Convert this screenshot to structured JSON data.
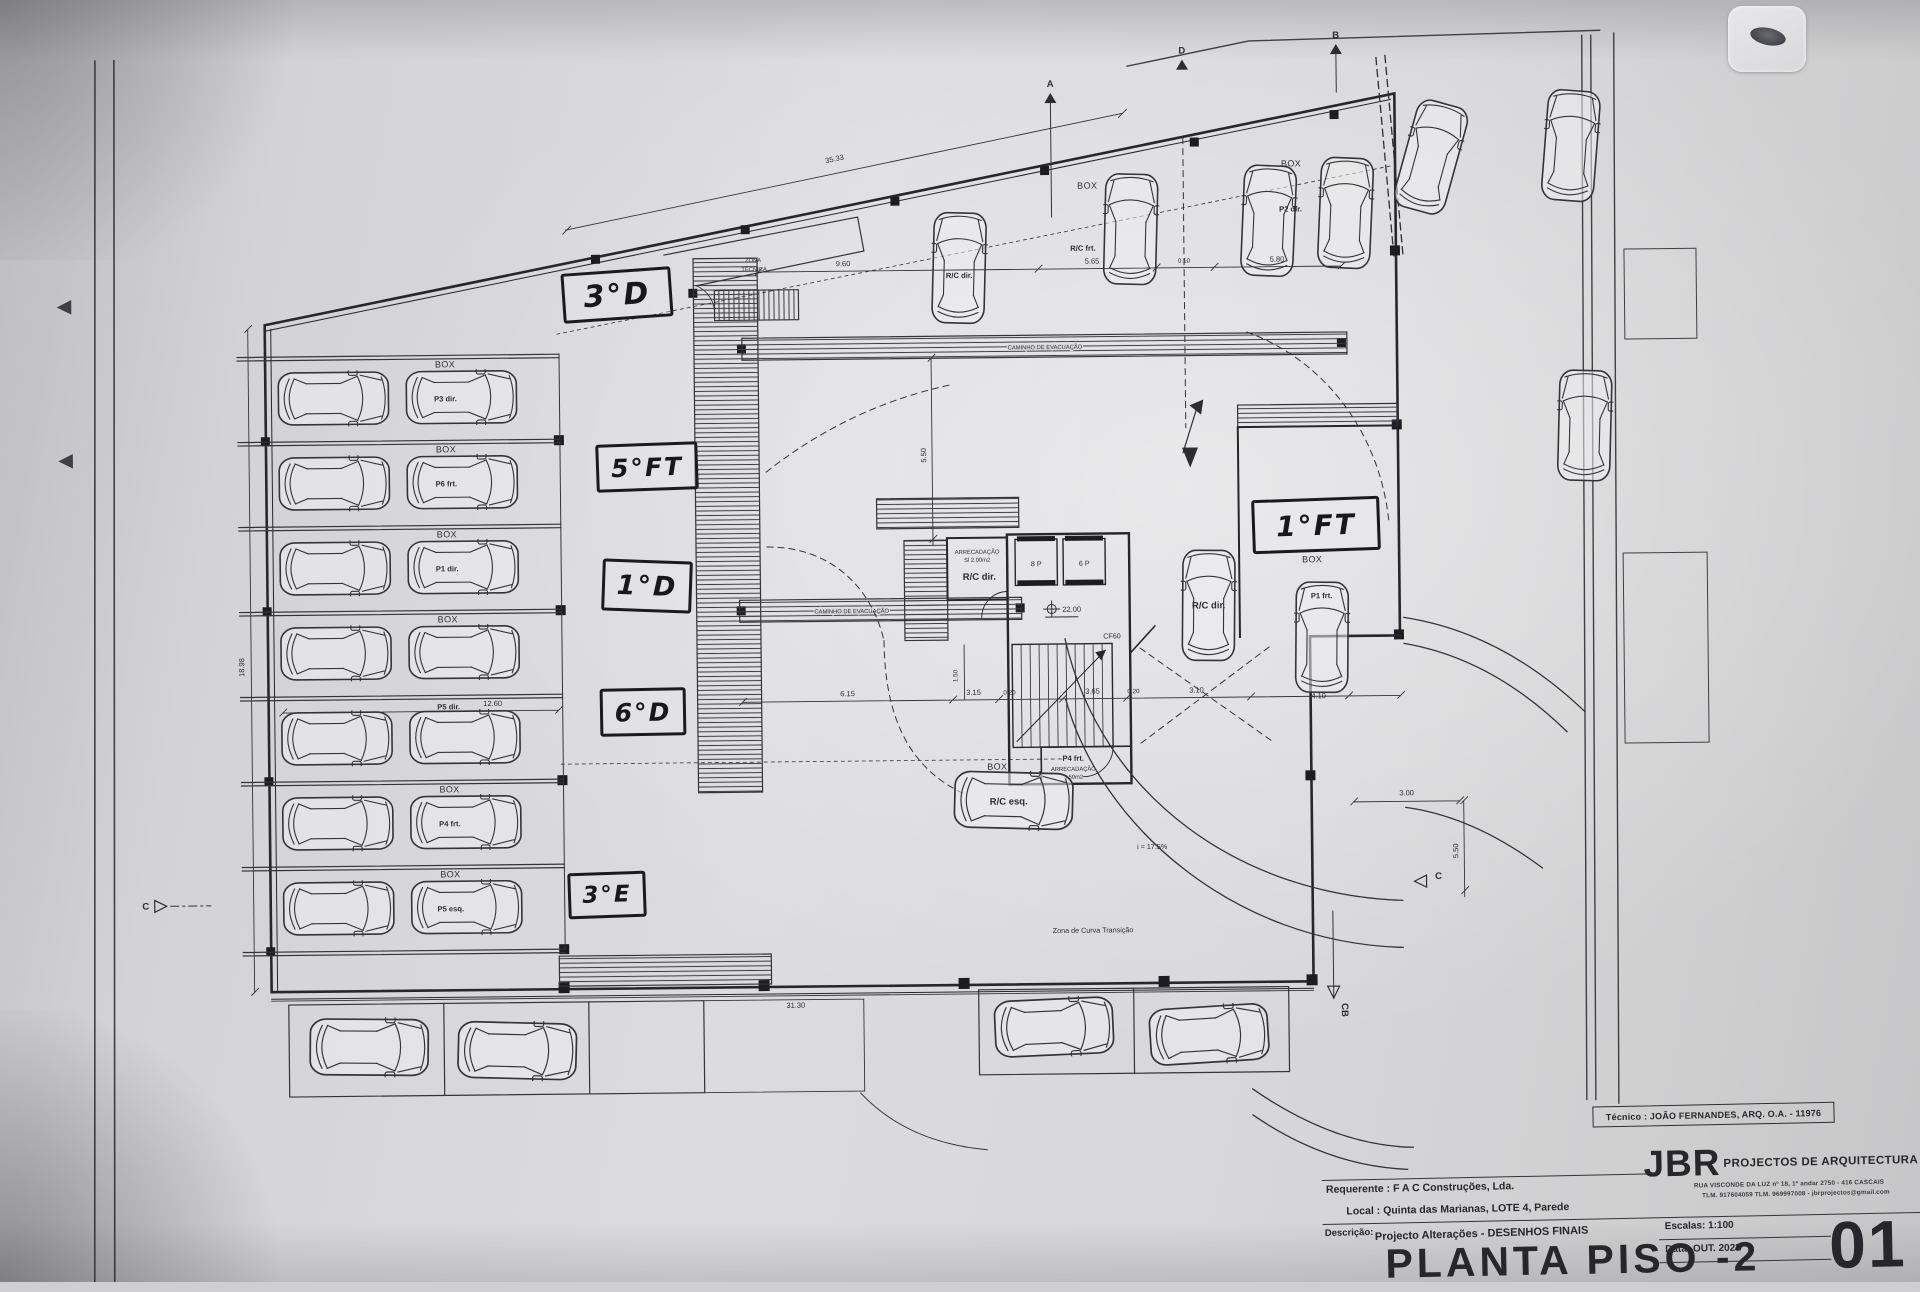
{
  "strings": {
    "box": "BOX",
    "caminho_evacuacao": "CAMINHO DE EVACUAÇÃO",
    "zona_tecnica_1": "ZONA",
    "zona_tecnica_2": "TÉCNICA",
    "zona_curva": "Zona de Curva Transição",
    "slope": "i = 17.5%",
    "cf60": "CF60",
    "elev_8p": "8 P",
    "elev_6p": "6 P",
    "level_22": "22.00",
    "arrecadacao": "ARRECADAÇÃO",
    "arrec_area_small": "Sl 2.00m2",
    "arrec_area_large": "3.50m2",
    "rc_frt": "R/C frt.",
    "rc_dir": "R/C dir.",
    "rc_esq": "R/C esq.",
    "p1_frt": "P1 frt.",
    "p2_dir": "P2 dir.",
    "p4_frt": "P4 frt."
  },
  "left_rows": [
    "P3 dir.",
    "P6 frt.",
    "P1 dir.",
    "",
    "P5 dir.",
    "P4 frt.",
    "P5 esq."
  ],
  "handwritten": {
    "l3d": "3°D",
    "l5ft": "5°FT",
    "l1d": "1°D",
    "l6d": "6°D",
    "l3e": "3°E",
    "l1ft": "1°FT"
  },
  "dims": {
    "d3533": "35.33",
    "d960": "9.60",
    "d565": "5.65",
    "d010": "0.10",
    "d580": "5.80",
    "d1898": "18.98",
    "d3130": "31.30",
    "d1260": "12.60",
    "d615": "6.15",
    "d315": "3.15",
    "d020a": "0.20",
    "d365": "3.65",
    "d020b": "0.20",
    "d310": "3.10",
    "d410": "4.10",
    "d300": "3.00",
    "d550r": "5.50",
    "d550l": "5.50",
    "d150": "1.50"
  },
  "markers": {
    "a": "A",
    "b": "B",
    "d": "D",
    "c_left": "C",
    "c_right": "C",
    "cb": "CB"
  },
  "title_block": {
    "tecnico": "Técnico : JOÃO FERNANDES, ARQ.   O.A. - 11976",
    "firm_initials": "JBR",
    "firm_name": "PROJECTOS DE ARQUITECTURA",
    "firm_address": "RUA VISCONDE DA LUZ nº 18, 1º andar  2750 - 416  CASCAIS",
    "firm_contact": "TLM. 917604059  TLM. 969997008 - jbrprojectos@gmail.com",
    "requerente_label": "Requerente :",
    "requerente_value": "F A C  Construções, Lda.",
    "local_label": "Local :",
    "local_value": "Quinta das Marianas, LOTE 4, Parede",
    "descricao_label": "Descrição:",
    "descricao_value": "Projecto Alterações - DESENHOS FINAIS",
    "drawing_title": "PLANTA PISO -2",
    "escalas_label": "Escalas:",
    "escalas_value": "1:100",
    "data_label": "Data:",
    "data_value": "OUT. 2023",
    "sheet_number": "01"
  }
}
